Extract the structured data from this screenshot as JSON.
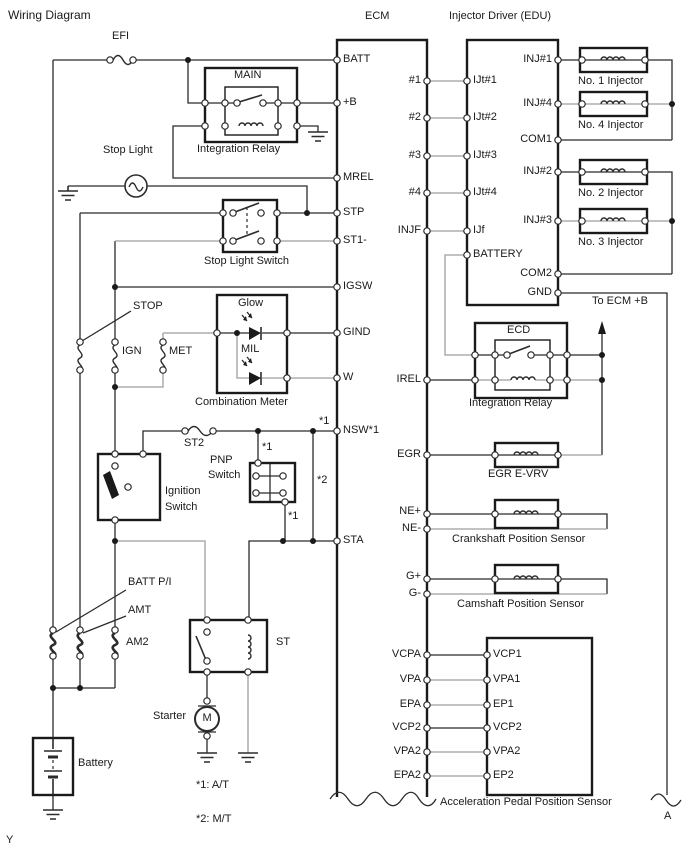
{
  "title": "Wiring Diagram",
  "colors": {
    "wire": "#2b2b2b",
    "wire_gray": "#9e9e9e",
    "background": "#ffffff"
  },
  "ecm": {
    "name": "ECM",
    "pins": {
      "batt": "BATT",
      "plus_b": "+B",
      "mrel": "MREL",
      "stp": "STP",
      "st1": "ST1-",
      "igsw": "IGSW",
      "gind": "GIND",
      "w": "W",
      "nsw": "NSW*1",
      "sta": "STA",
      "n1": "#1",
      "n2": "#2",
      "n3": "#3",
      "n4": "#4",
      "injf": "INJF",
      "irel": "IREL",
      "egr": "EGR",
      "ne_p": "NE+",
      "ne_m": "NE-",
      "g_p": "G+",
      "g_m": "G-",
      "vcpa": "VCPA",
      "vpa": "VPA",
      "epa": "EPA",
      "vcp2": "VCP2",
      "vpa2": "VPA2",
      "epa2": "EPA2"
    }
  },
  "edu": {
    "name": "Injector Driver (EDU)",
    "pins": {
      "ijt1": "IJt#1",
      "ijt2": "IJt#2",
      "ijt3": "IJt#3",
      "ijt4": "IJt#4",
      "ijf": "IJf",
      "battery": "BATTERY",
      "inj1": "INJ#1",
      "inj4": "INJ#4",
      "com1": "COM1",
      "inj2": "INJ#2",
      "inj3": "INJ#3",
      "com2": "COM2",
      "gnd": "GND"
    }
  },
  "injectors": {
    "no1": "No. 1 Injector",
    "no4": "No. 4 Injector",
    "no2": "No. 2 Injector",
    "no3": "No. 3 Injector"
  },
  "fuses": {
    "efi": "EFI",
    "stop": "STOP",
    "ign": "IGN",
    "met": "MET",
    "st2": "ST2",
    "batt_pi": "BATT P/I",
    "amt": "AMT",
    "am2": "AM2"
  },
  "relays": {
    "main": "MAIN",
    "integration": "Integration Relay",
    "ecd": "ECD",
    "integration2": "Integration Relay",
    "st": "ST"
  },
  "components": {
    "stop_light": "Stop Light",
    "stop_light_switch": "Stop Light Switch",
    "glow": "Glow",
    "mil": "MIL",
    "combination_meter": "Combination Meter",
    "pnp1": "PNP",
    "pnp2": "Switch",
    "ignition1": "Ignition",
    "ignition2": "Switch",
    "starter": "Starter",
    "motor_m": "M",
    "battery": "Battery",
    "egr_evrv": "EGR E-VRV",
    "crankshaft": "Crankshaft Position Sensor",
    "camshaft": "Camshaft Position Sensor",
    "app": "Acceleration Pedal Position Sensor",
    "to_ecm_b": "To ECM +B"
  },
  "app_pins": {
    "vcp1": "VCP1",
    "vpa1": "VPA1",
    "ep1": "EP1",
    "vcp2": "VCP2",
    "vpa2": "VPA2",
    "ep2": "EP2"
  },
  "notes": {
    "n1": "*1: A/T",
    "n2": "*2: M/T",
    "star1": "*1",
    "star2": "*2"
  },
  "markers": {
    "a": "A",
    "y": "Y"
  }
}
